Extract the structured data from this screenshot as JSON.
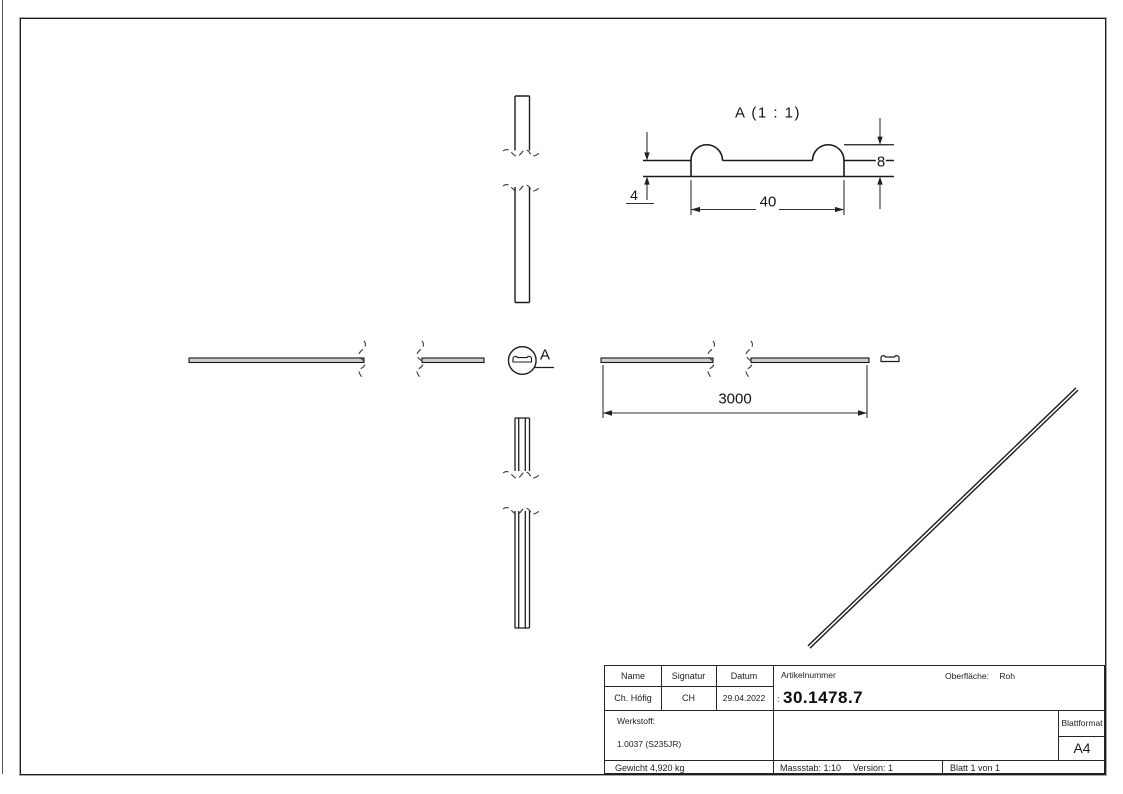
{
  "views": {
    "detail": {
      "title": "A (1 : 1)",
      "dim_height": "8",
      "dim_thickness": "4",
      "dim_width": "40"
    },
    "front": {
      "dim_length": "3000"
    },
    "callout": {
      "label": "A"
    }
  },
  "title_block": {
    "headers": {
      "name": "Name",
      "signatur": "Signatur",
      "datum": "Datum"
    },
    "values": {
      "name": "Ch. Höfig",
      "signatur": "CH",
      "datum": "29.04.2022"
    },
    "artikelnummer": {
      "label": "Artikelnummer",
      "prefix": ":",
      "value": "30.1478.7"
    },
    "oberflaeche": {
      "label": "Oberfläche:",
      "value": "Roh"
    },
    "werkstoff": {
      "label": "Werkstoff:",
      "value": "1.0037 (S235JR)"
    },
    "blattformat": {
      "label": "Blattformat",
      "value": "A4"
    },
    "gewicht": "Gewicht 4,920 kg",
    "massstab": "Massstab: 1:10",
    "version": "Version: 1",
    "blatt": "Blatt 1 von 1"
  }
}
